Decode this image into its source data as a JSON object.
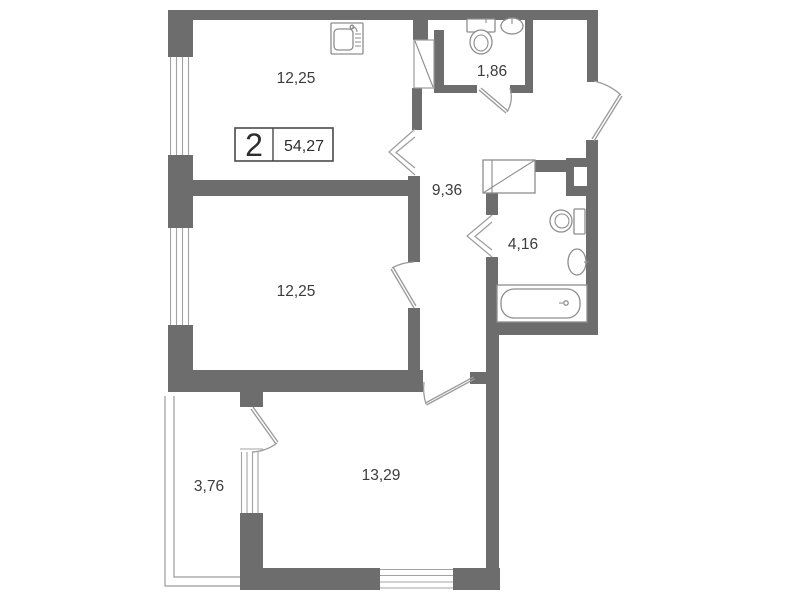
{
  "plan": {
    "type": "apartment-floor-plan",
    "legend": {
      "rooms_count": "2",
      "total_area": "54,27"
    },
    "rooms": {
      "kitchen": {
        "area": "12,25"
      },
      "wc": {
        "area": "1,86"
      },
      "hallway": {
        "area": "9,36"
      },
      "bathroom": {
        "area": "4,16"
      },
      "bedroom": {
        "area": "12,25"
      },
      "living_room": {
        "area": "13,29"
      },
      "balcony": {
        "area": "3,76"
      }
    },
    "fixtures": [
      "kitchen-sink-icon",
      "toilet-icon",
      "washbasin-icon",
      "bathtub-icon",
      "wardrobe",
      "vent-shaft"
    ],
    "colors": {
      "wall": "#6d6d6d",
      "thin_line": "#a3a3a3",
      "door_line": "#999999",
      "text": "#3c3c3c",
      "background": "#ffffff"
    }
  }
}
